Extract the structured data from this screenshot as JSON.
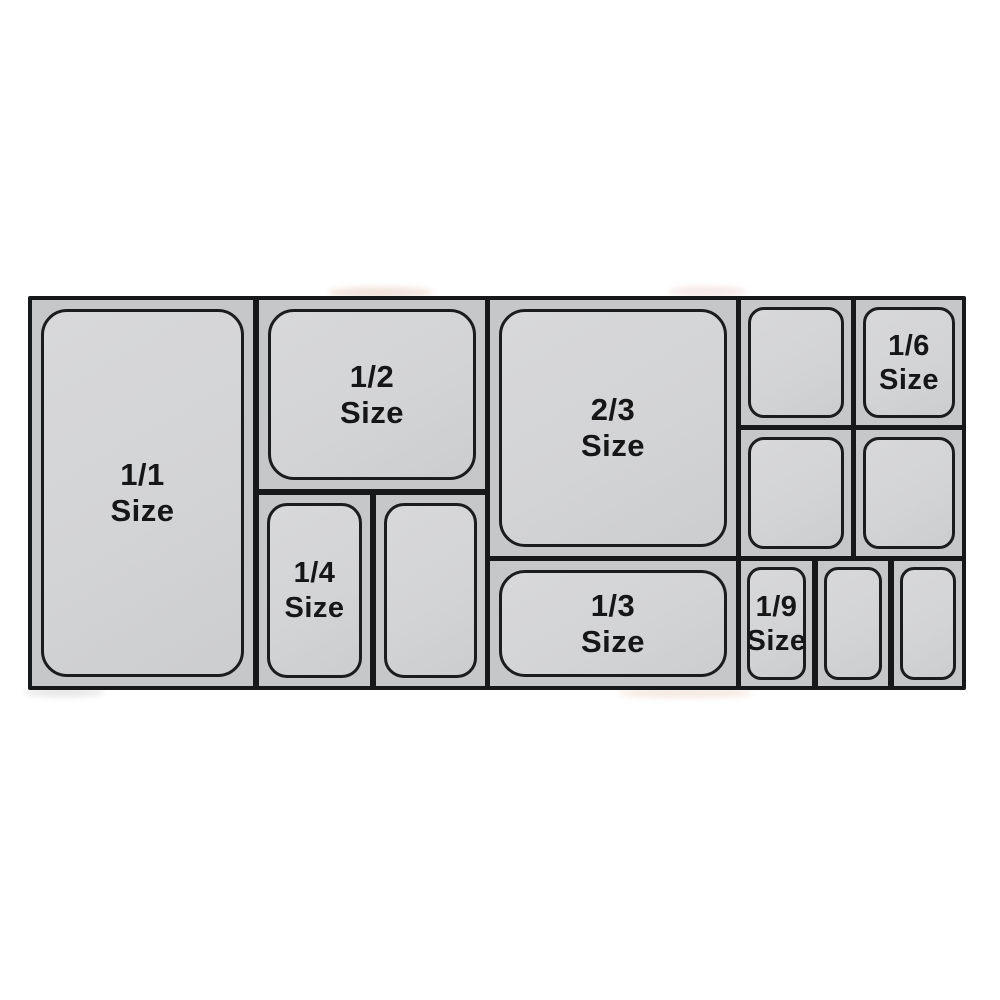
{
  "diagram": {
    "kind": "food-pan-size-layout"
  },
  "colors": {
    "frame": "#17181a",
    "section_bg": "#c6c7c9",
    "pan_fill": "#d3d4d6",
    "pan_border": "#1b1c1e",
    "label_text": "#161616",
    "page_bg": "#ffffff"
  },
  "cells": [
    {
      "id": "1-1",
      "line1": "1/1",
      "line2": "Size"
    },
    {
      "id": "1-2",
      "line1": "1/2",
      "line2": "Size"
    },
    {
      "id": "1-4",
      "line1": "1/4",
      "line2": "Size"
    },
    {
      "id": "1-4-unlabeled",
      "line1": "",
      "line2": ""
    },
    {
      "id": "2-3",
      "line1": "2/3",
      "line2": "Size"
    },
    {
      "id": "1-3",
      "line1": "1/3",
      "line2": "Size"
    },
    {
      "id": "1-6-unlabeled-a",
      "line1": "",
      "line2": ""
    },
    {
      "id": "1-6",
      "line1": "1/6",
      "line2": "Size"
    },
    {
      "id": "1-6-unlabeled-b",
      "line1": "",
      "line2": ""
    },
    {
      "id": "1-6-unlabeled-c",
      "line1": "",
      "line2": ""
    },
    {
      "id": "1-9",
      "line1": "1/9",
      "line2": "Size"
    },
    {
      "id": "1-9-unlabeled-a",
      "line1": "",
      "line2": ""
    },
    {
      "id": "1-9-unlabeled-b",
      "line1": "",
      "line2": ""
    }
  ]
}
